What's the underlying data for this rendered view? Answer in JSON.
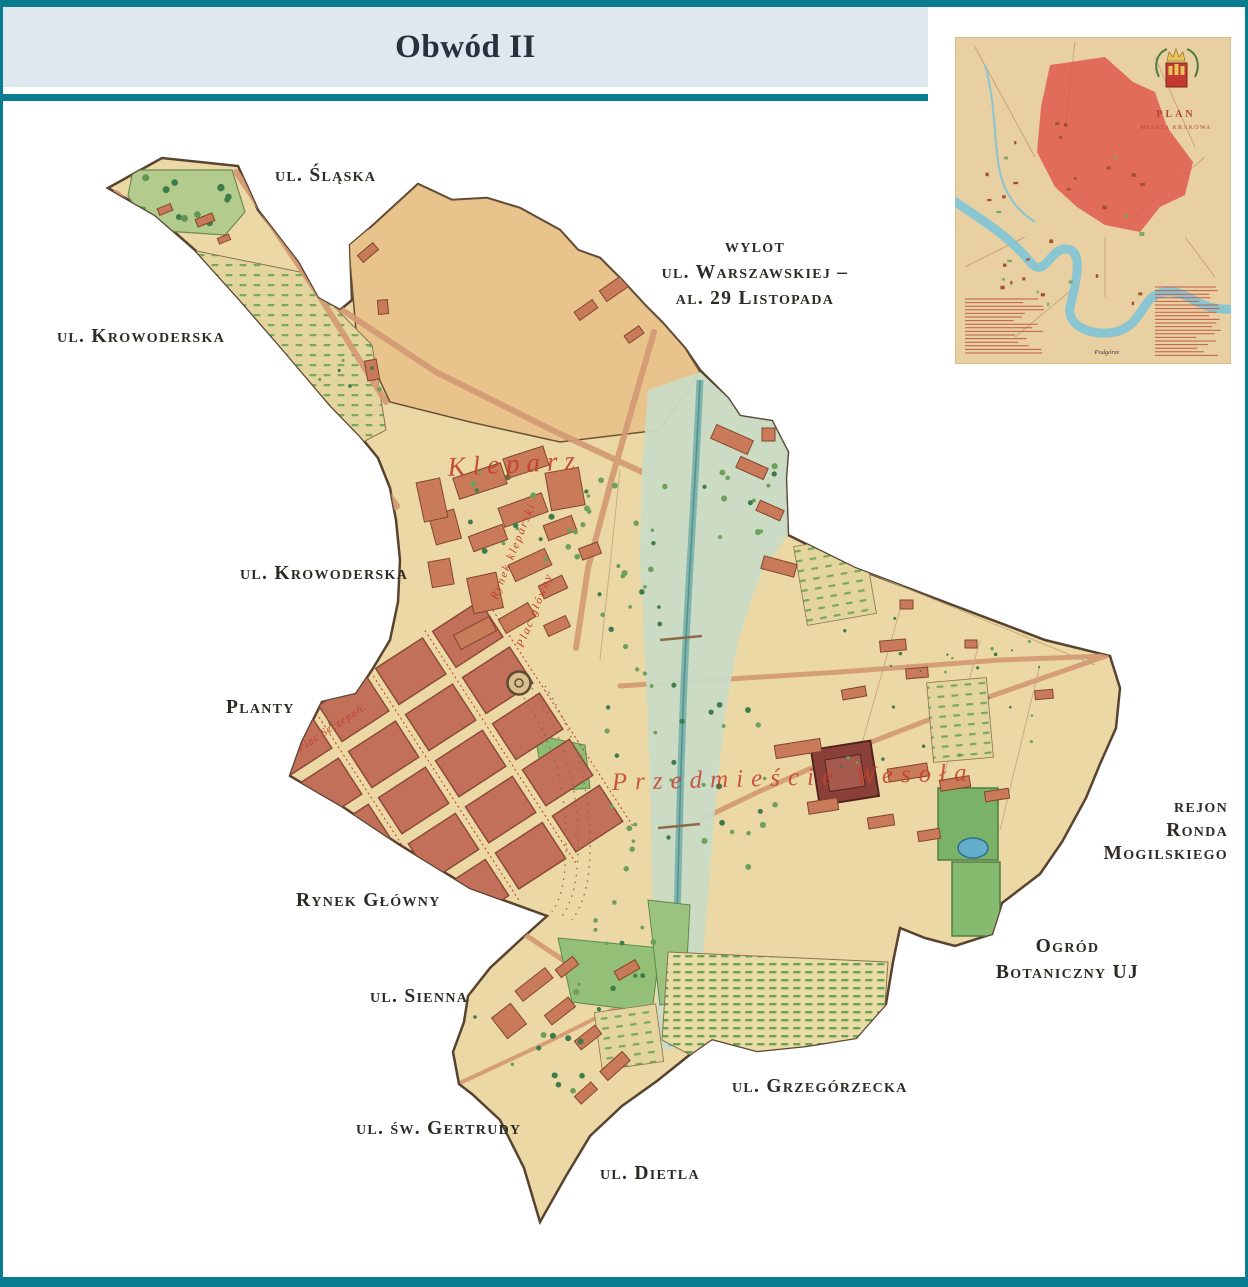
{
  "header": {
    "title": "Obwód II"
  },
  "street_labels": [
    {
      "id": "slaska",
      "text": "ul. Śląska"
    },
    {
      "id": "wylot",
      "text": "wylot\nul. Warszawskiej –\nal. 29 Listopada"
    },
    {
      "id": "krowoderska-1",
      "text": "ul. Krowoderska"
    },
    {
      "id": "krowoderska-2",
      "text": "ul. Krowoderska"
    },
    {
      "id": "planty",
      "text": "Planty"
    },
    {
      "id": "rynek-glowny",
      "text": "Rynek Główny"
    },
    {
      "id": "sienna",
      "text": "ul. Sienna"
    },
    {
      "id": "gertrudy",
      "text": "ul. św. Gertrudy"
    },
    {
      "id": "dietla",
      "text": "ul. Dietla"
    },
    {
      "id": "grzegorzecka",
      "text": "ul. Grzegórzecka"
    },
    {
      "id": "ogrod",
      "text": "Ogród\nBotaniczny UJ"
    },
    {
      "id": "rondo",
      "text": "rejon\nRonda\nMogilskiego"
    }
  ],
  "map_annotations": {
    "kleparz": "Kleparz",
    "przedmiescie": "Przedmieście Wesoła",
    "rynek_kleparski": "Rynek kleparski",
    "plac_glowny": "Plac główny",
    "plac_szczepanski": "Plac Szczepań."
  },
  "inset": {
    "plan_title": "PLAN",
    "plan_subtitle": "MIASTA KRAKOWA",
    "caption": "Podgórze"
  },
  "colors": {
    "frame_teal": "#0a7c90",
    "header_band": "#dfe7ef",
    "parchment": "#ecd8a4",
    "field_tan": "#e8c48c",
    "canal_band": "#cadbc5",
    "canal_stream": "#7eb5ae",
    "building_red": "#c97a58",
    "block_terracotta": "#c2705a",
    "garden_green": "#8cbd72",
    "script_red": "#c2402e",
    "inset_district_red": "#e0554b",
    "inset_river_blue": "#8ac5d2"
  }
}
